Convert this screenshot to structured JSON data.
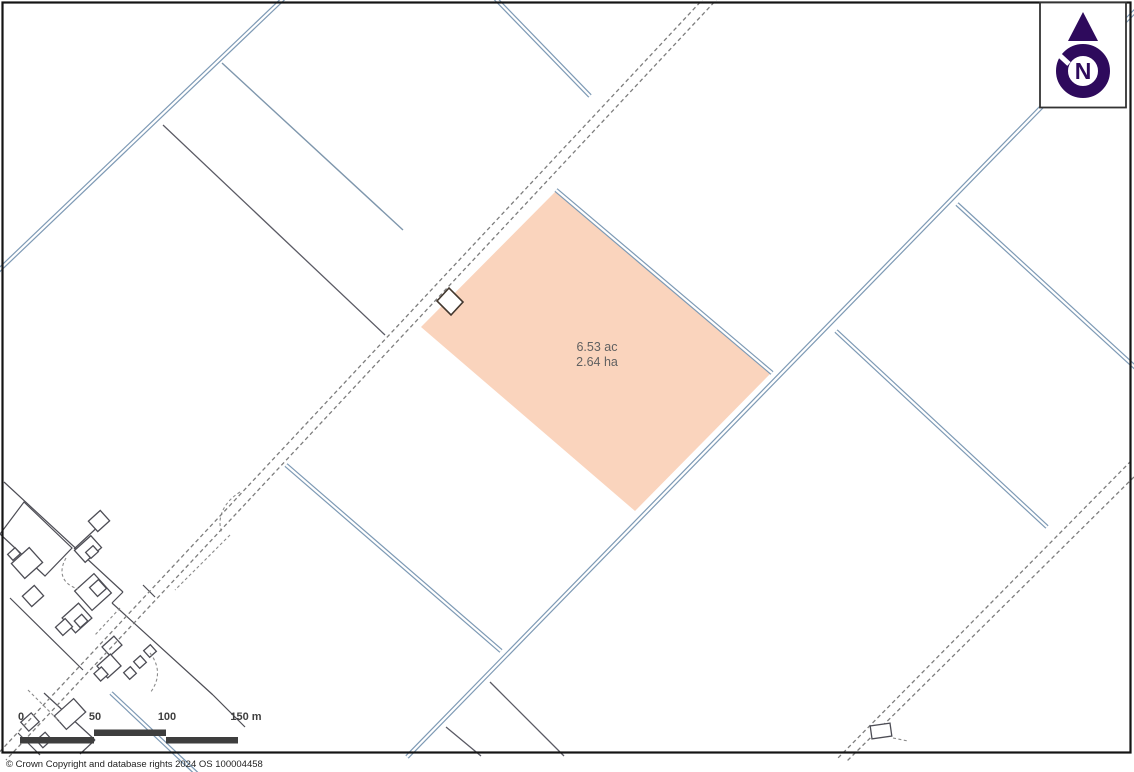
{
  "map": {
    "parcel": {
      "area_acres": "6.53 ac",
      "area_hectares": "2.64 ha"
    },
    "north_indicator": {
      "label": "N"
    },
    "scale_bar": {
      "labels": [
        "0",
        "50",
        "100",
        "150 m"
      ]
    },
    "footer": {
      "copyright": "© Crown Copyright and database rights 2024 OS 100004458"
    },
    "colors": {
      "parcel_fill": "#FAD4BD",
      "drain_line_blue": "#7E9AB5",
      "compass_purple": "#2E0A5C"
    }
  }
}
